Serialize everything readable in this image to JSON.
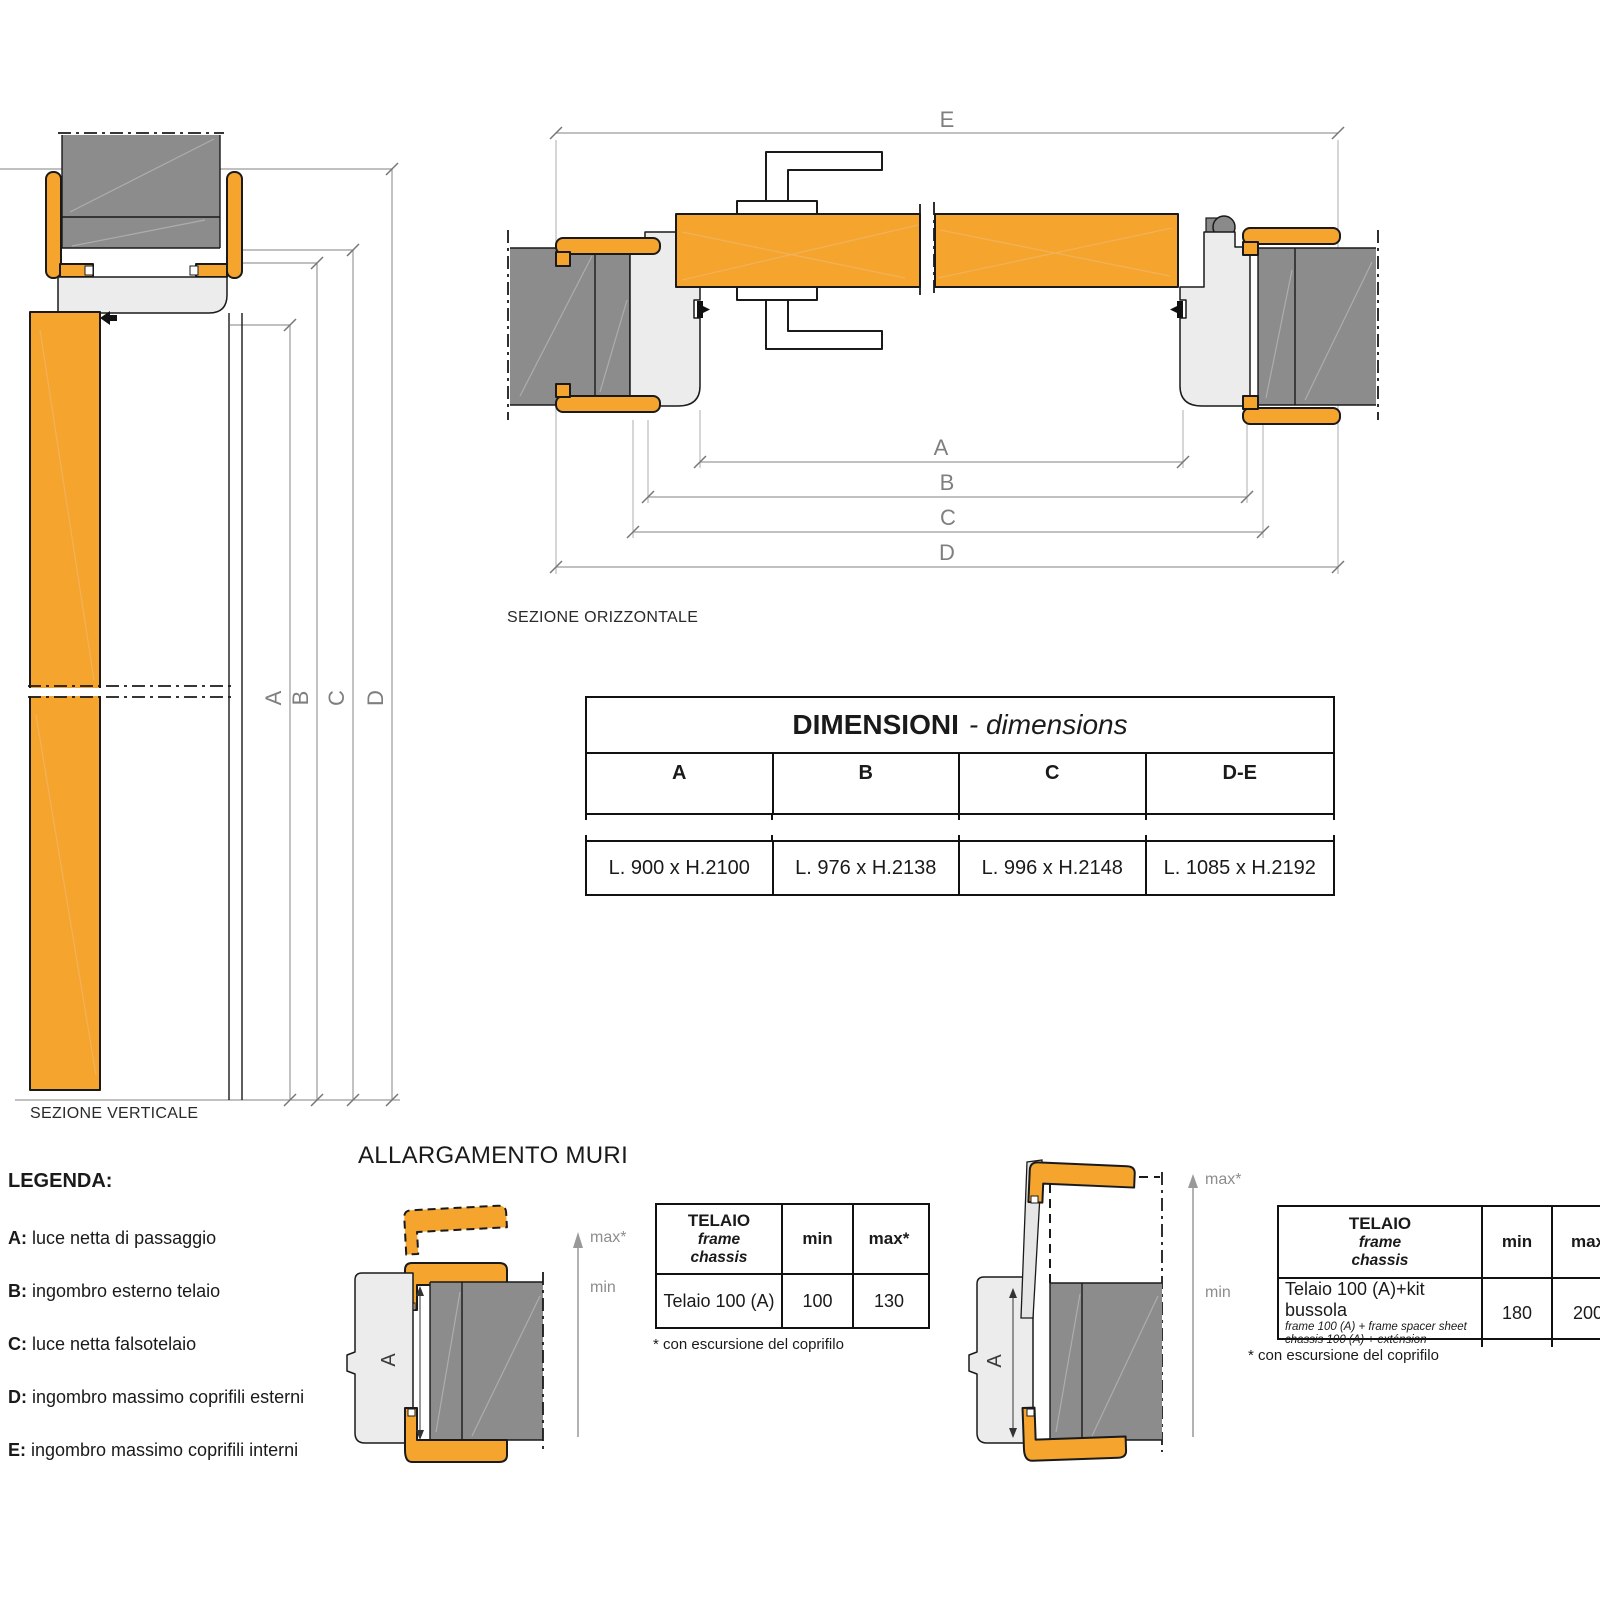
{
  "colors": {
    "accent_orange": "#F5A42D",
    "wall_gray": "#8C8C8C",
    "frame_gray": "#ECECEC",
    "line_dark": "#1A1A1A",
    "dim_gray": "#9A9A9A"
  },
  "dims": {
    "a": "A",
    "b": "B",
    "c": "C",
    "d": "D",
    "e": "E"
  },
  "sections": {
    "vertical_label": "SEZIONE VERTICALE",
    "horizontal_label": "SEZIONE ORIZZONTALE"
  },
  "dimensions_table": {
    "title_bold": "DIMENSIONI",
    "title_italic": "- dimensions",
    "columns": [
      "A",
      "B",
      "C",
      "D-E"
    ],
    "values": [
      "L. 900 x H.2100",
      "L. 976 x H.2138",
      "L. 996 x H.2148",
      "L. 1085 x H.2192"
    ]
  },
  "legend": {
    "title": "LEGENDA:",
    "items": [
      {
        "key": "A:",
        "text": "luce netta di passaggio"
      },
      {
        "key": "B:",
        "text": "ingombro esterno telaio"
      },
      {
        "key": "C:",
        "text": "luce netta falsotelaio"
      },
      {
        "key": "D:",
        "text": "ingombro massimo coprifili esterni"
      },
      {
        "key": "E:",
        "text": "ingombro massimo coprifili interni"
      }
    ]
  },
  "allargamento": {
    "title": "ALLARGAMENTO MURI",
    "frame_letter": "A",
    "max_label": "max*",
    "min_label": "min",
    "table1": {
      "header_line1": "TELAIO",
      "header_line2": "frame",
      "header_line3": "chassis",
      "col_min": "min",
      "col_max": "max*",
      "row_label": "Telaio 100 (A)",
      "min_value": "100",
      "max_value": "130",
      "footnote": "* con escursione del coprifilo"
    },
    "table2": {
      "header_line1": "TELAIO",
      "header_line2": "frame",
      "header_line3": "chassis",
      "col_min": "min",
      "col_max": "max",
      "row_label": "Telaio 100 (A)+kit bussola",
      "row_sub1": "frame 100 (A) + frame spacer sheet",
      "row_sub2": "chassis 100 (A) + exténsion",
      "min_value": "180",
      "max_value": "200",
      "footnote": "* con escursione del coprifilo"
    }
  }
}
